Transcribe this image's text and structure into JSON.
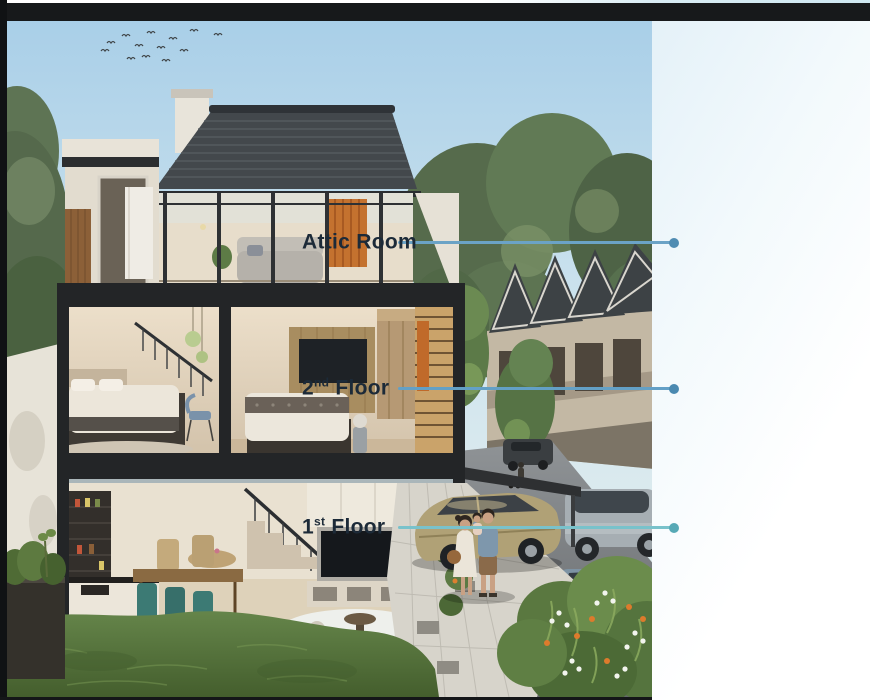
{
  "callouts": [
    {
      "id": "attic-room",
      "num": "Attic Room",
      "sup": "",
      "rest": "",
      "line_color": "#6ba3c6",
      "dot_color": "#4f8cb2"
    },
    {
      "id": "second-floor",
      "num": "2",
      "sup": "nd",
      "rest": " Floor",
      "line_color": "#63a0c6",
      "dot_color": "#4a89b0"
    },
    {
      "id": "first-floor",
      "num": "1",
      "sup": "st",
      "rest": " Floor",
      "line_color": "#79c2cb",
      "dot_color": "#57a9b6"
    }
  ],
  "colors": {
    "label_text": "#1c2a38",
    "top_bar": "#17191b",
    "left_bar": "#101214",
    "bottom_strip": "#141618",
    "panel_tint": "#e4f1f8",
    "roof": "#43484c",
    "structure_frame": "#232527",
    "accent_orange_panel": "#c4722f",
    "grass": "#5e7d42"
  }
}
